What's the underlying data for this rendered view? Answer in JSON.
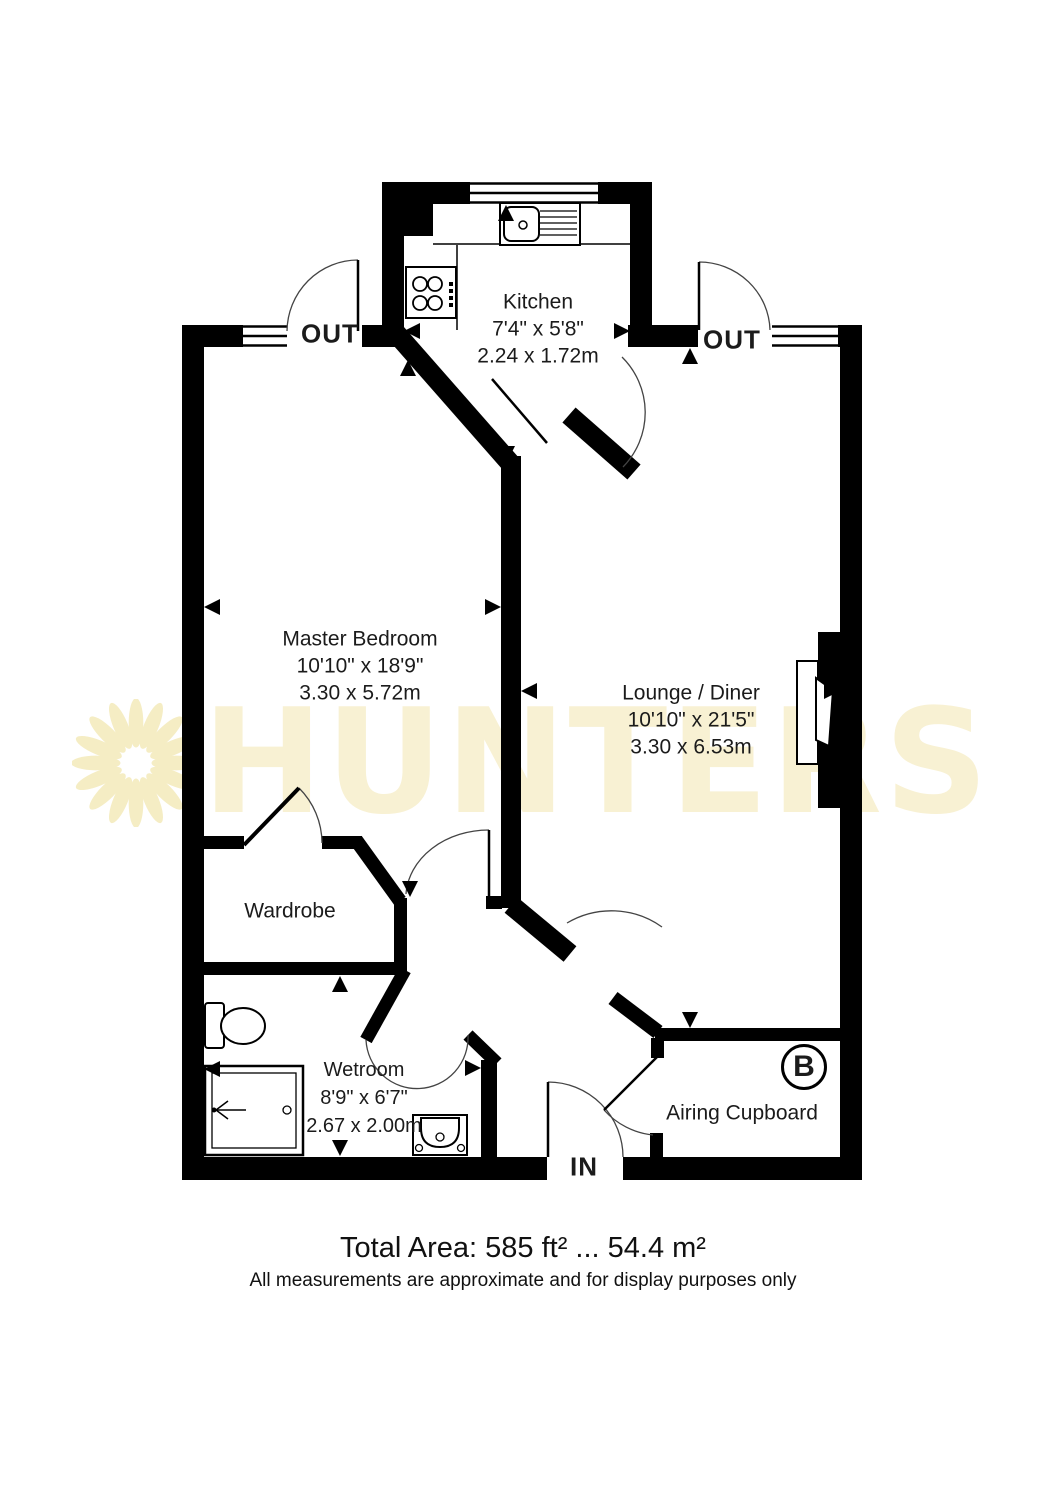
{
  "watermark": {
    "brand": "HUNTERS"
  },
  "rooms": {
    "kitchen": {
      "name": "Kitchen",
      "imperial": "7'4\" x 5'8\"",
      "metric": "2.24 x 1.72m"
    },
    "master_bedroom": {
      "name": "Master Bedroom",
      "imperial": "10'10\" x 18'9\"",
      "metric": "3.30 x 5.72m"
    },
    "lounge_diner": {
      "name": "Lounge / Diner",
      "imperial": "10'10\" x 21'5\"",
      "metric": "3.30 x 6.53m"
    },
    "wardrobe": {
      "name": "Wardrobe"
    },
    "wetroom": {
      "name": "Wetroom",
      "imperial": "8'9\" x 6'7\"",
      "metric": "2.67 x 2.00m"
    },
    "airing_cupboard": {
      "name": "Airing Cupboard"
    }
  },
  "door_labels": {
    "out_left": "OUT",
    "out_right": "OUT",
    "in": "IN"
  },
  "boiler_badge": "B",
  "footer": {
    "total_area": "Total Area: 585 ft² ... 54.4 m²",
    "disclaimer": "All measurements are approximate and for display purposes only"
  },
  "colors": {
    "wall": "#000000",
    "watermark_text": "#F8F1D3",
    "watermark_sun": "#F5EDC4"
  }
}
